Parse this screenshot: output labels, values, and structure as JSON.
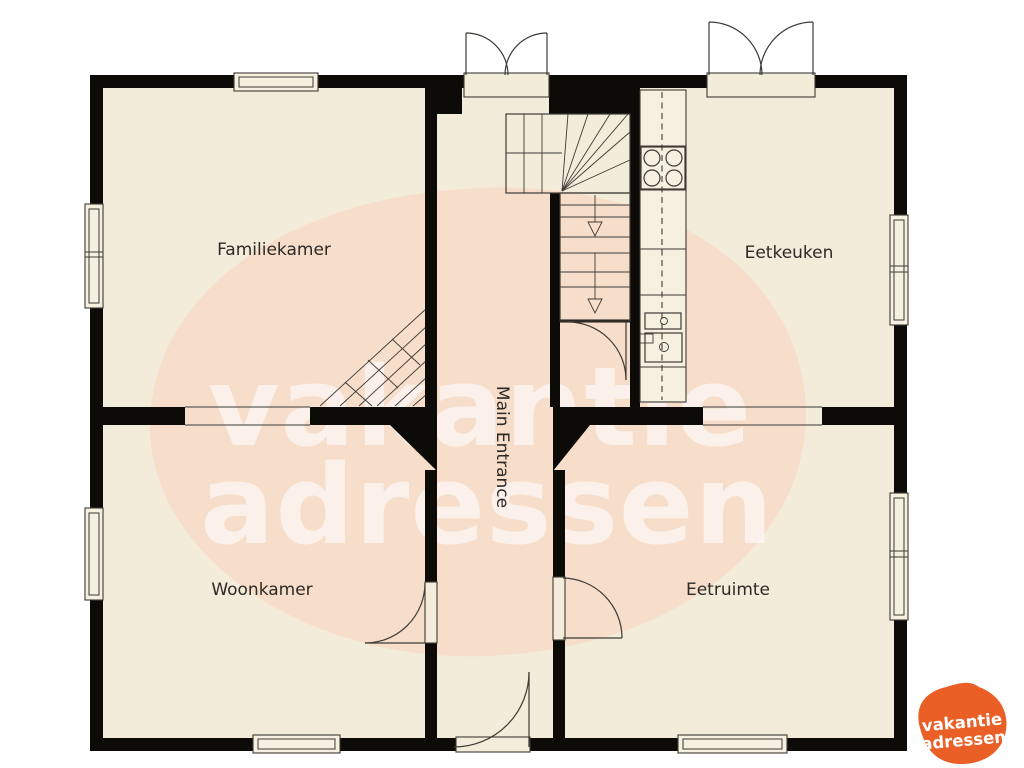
{
  "plan_title": "floor-plan",
  "rooms": [
    {
      "name": "familiekamer",
      "label": "Familiekamer"
    },
    {
      "name": "eetkeuken",
      "label": "Eetkeuken"
    },
    {
      "name": "woonkamer",
      "label": "Woonkamer"
    },
    {
      "name": "eetruimte",
      "label": "Eetruimte"
    },
    {
      "name": "main_entrance",
      "label": "Main Entrance"
    }
  ],
  "watermark": {
    "line1": "vakantie",
    "line2": "adressen"
  },
  "logo": {
    "line1": "vakantie",
    "line2": "adressen"
  },
  "colors": {
    "background": "#ffffff",
    "floor": "#f3ecda",
    "floor_light": "#f6f0e1",
    "wall": "#0d0b08",
    "line": "#3e3a35",
    "watermark_pink": "#f7d3c0",
    "watermark_text": "#ffffff",
    "logo_orange": "#e95f26"
  }
}
